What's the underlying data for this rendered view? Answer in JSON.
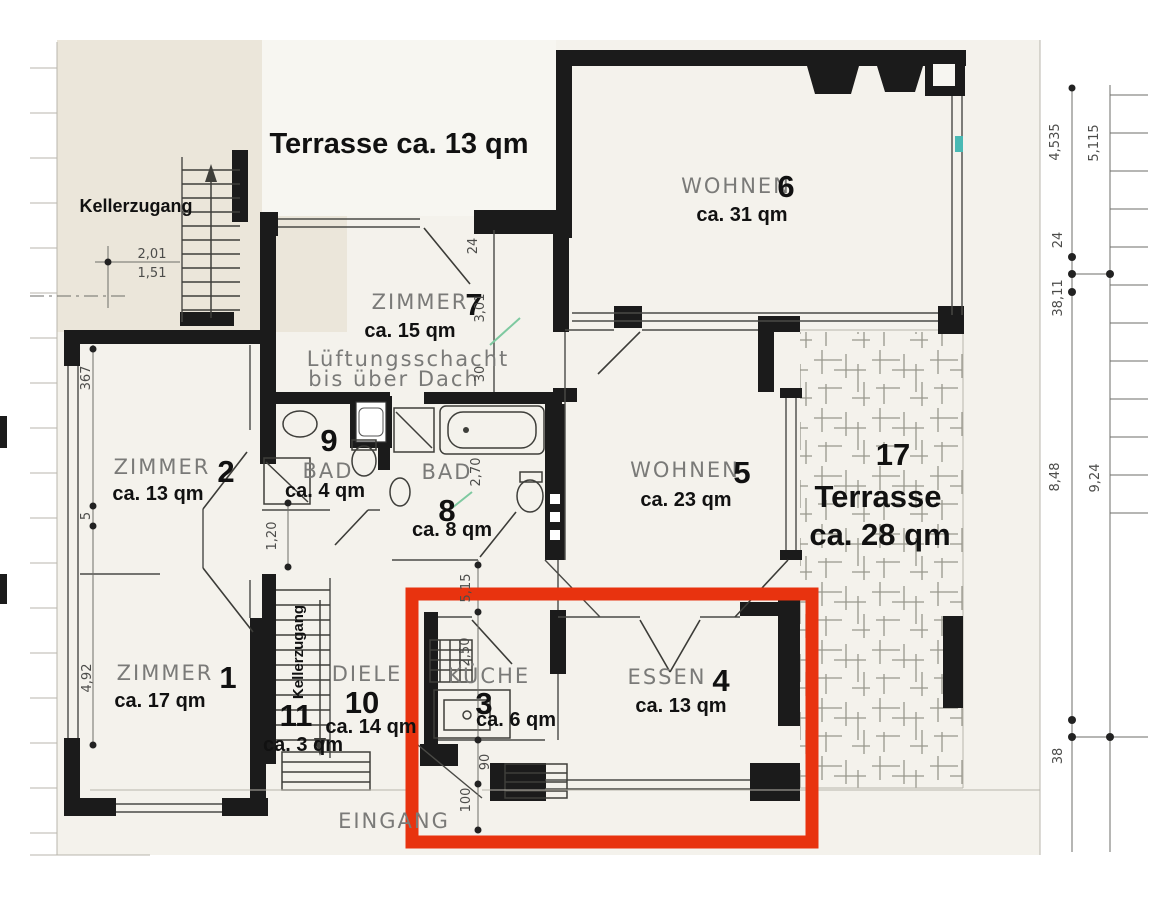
{
  "title": "Terrasse ca. 13 qm",
  "labels": {
    "kellerzugang_top": "Kellerzugang",
    "kellerzugang_stair": "Kellerzugang",
    "lueftung1": "Lüftungsschacht",
    "lueftung2": "bis über Dach",
    "eingang": "EINGANG"
  },
  "rooms": [
    {
      "name": "ZIMMER",
      "number": "1",
      "area": "ca. 17 qm"
    },
    {
      "name": "ZIMMER",
      "number": "2",
      "area": "ca. 13 qm"
    },
    {
      "name": "KÜCHE",
      "number": "3",
      "area": "ca. 6 qm"
    },
    {
      "name": "ESSEN",
      "number": "4",
      "area": "ca. 13 qm"
    },
    {
      "name": "WOHNEN",
      "number": "5",
      "area": "ca. 23 qm"
    },
    {
      "name": "WOHNEN",
      "number": "6",
      "area": "ca. 31 qm"
    },
    {
      "name": "ZIMMER",
      "number": "7",
      "area": "ca. 15 qm"
    },
    {
      "name": "BAD",
      "number": "8",
      "area": "ca. 8 qm"
    },
    {
      "name": "BAD",
      "number": "9",
      "area": "ca. 4 qm"
    },
    {
      "name": "DIELE",
      "number": "10",
      "area": "ca. 14 qm"
    },
    {
      "name": "",
      "number": "11",
      "area": "ca. 3 qm"
    },
    {
      "name": "Terrasse",
      "number": "17",
      "area": "ca. 28 qm"
    }
  ],
  "dims": {
    "d201": "2,01",
    "d151": "1,51",
    "d367": "367",
    "d5": "5",
    "d492": "4,92",
    "d120": "1,20",
    "d24": "24",
    "d301": "3,01",
    "d30": "30",
    "d270": "2,70",
    "d515": "5,15",
    "d250": "2,50",
    "d90": "90",
    "d100": "100",
    "d4535": "4,535",
    "d5115": "5,115",
    "d24r": "24",
    "d3811": "38,11",
    "d848": "8,48",
    "d924": "9,24",
    "d38": "38"
  },
  "colors": {
    "highlight_red": "#e8330f",
    "wall_black": "#1b1b1b",
    "label_grey": "#7a7a78",
    "accent_teal": "#49b9b4",
    "paper": "#f4f2ec"
  }
}
